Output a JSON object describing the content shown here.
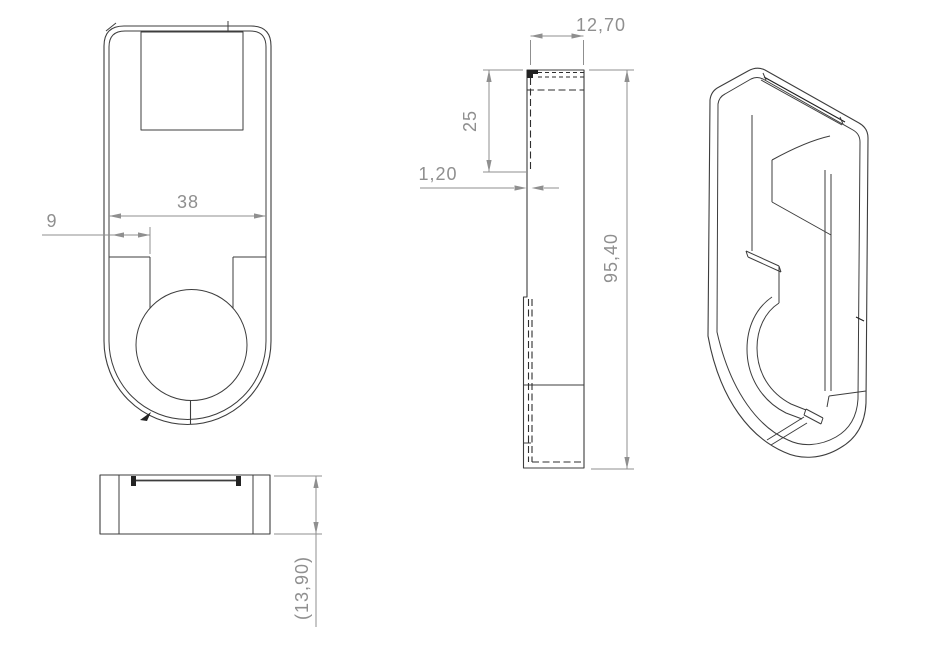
{
  "colors": {
    "background": "#ffffff",
    "part_line": "#3d3d3d",
    "hidden_line": "#2e2e2e",
    "dimension": "#8f8f8f"
  },
  "views": {
    "front": {
      "dimensions": {
        "inner_width": "38",
        "slot_offset": "9"
      }
    },
    "bottom": {
      "dimensions": {
        "overall_depth": "(13,90)"
      }
    },
    "side": {
      "dimensions": {
        "depth": "12,70",
        "window_depth": "25",
        "wall_thickness": "1,20",
        "overall_height": "95,40"
      }
    }
  }
}
